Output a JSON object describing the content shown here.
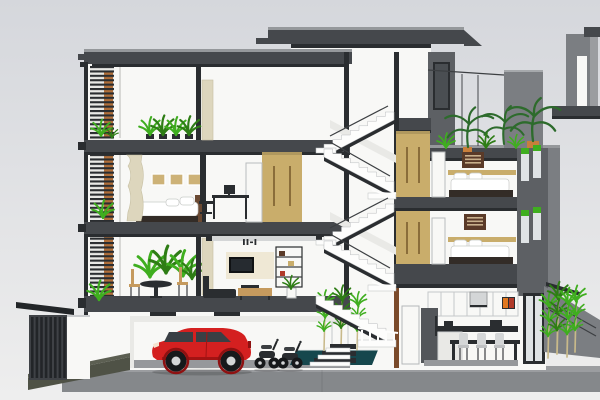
{
  "meta": {
    "description": "3D cutaway section rendering of a four-storey townhouse, SketchUp style",
    "canvas_width": 600,
    "canvas_height": 400
  },
  "palette": {
    "sky_top": "#d5d7dc",
    "sky_bottom": "#eeeeee",
    "ground_top": "#9b9da0",
    "ground_face": "#85888b",
    "slab": "#45484c",
    "slab_dark": "#2a2d30",
    "slab_edge": "#95989b",
    "wall_white": "#f8f8f6",
    "wall_shadow": "#e9e9e6",
    "wall_gray": "#5d6064",
    "wall_gray_light": "#7b7e82",
    "wall_line": "#d8d8d5",
    "wood_tan": "#c9ad6b",
    "wood_tan_dark": "#8a6d3a",
    "wood_orange": "#b06f3a",
    "wood_brown": "#7a4a2a",
    "wood_console": "#c59a5e",
    "panel_beige": "#efe8d5",
    "curtain_beige": "#ddd6bd",
    "green_bright": "#3fae1f",
    "green_dark": "#2e7d15",
    "palm_green": "#2d6b2c",
    "bamboo_stem": "#c8b98a",
    "pot_orange": "#c97f3b",
    "car_red": "#d42020",
    "car_red_dark": "#a31313",
    "glass_light": "#dfe3e5",
    "glass_dark": "#3a3f44",
    "pond_teal": "#16474d",
    "gate_dark": "#222528",
    "gate_frame": "#3f4246",
    "ramp_olive": "#4f5246",
    "ramp_light": "#5c5f52",
    "furniture_dark": "#2a2d30",
    "steel_light": "#d4d6d7",
    "stair_white": "#fdfdfc",
    "art_brown": "#5a3a28",
    "art_line": "#c9b08c",
    "bed_brown": "#6b4a33",
    "bed_base": "#332c27",
    "tire_black": "#17191b",
    "window_tan": "#cdb277",
    "floor_gray": "#96989b",
    "fridge_gray": "#53565a",
    "tv_black": "#101214",
    "accent_orange": "#e07820",
    "accent_red": "#b03a2a",
    "stool_seat": "#bfc1c3"
  },
  "scene": {
    "style": "sketchup-section-perspective",
    "site": {
      "ground": "concrete-pavement",
      "front_gate": "dark-slatted-gate",
      "driveway": "ramp-to-garage",
      "backyard": [
        "sloped-boundary-wall",
        "bamboo-plants",
        "exterior-steps"
      ]
    },
    "building": {
      "stair_tower": {
        "roof": "flat-concrete-roof",
        "stairs": [
          "switchback-flight-level3-4",
          "switchback-flight-level2-3",
          "garage-flight"
        ],
        "window": "tall-dark-window"
      },
      "left_wing": {
        "roof": "flat-concrete-roof-with-brackets",
        "facade": [
          "vertical-post",
          "timber-louver-screen",
          "balcony-planters"
        ],
        "level4_loggia": {
          "objects": [
            "planter-grasses",
            "partition-curtain"
          ]
        },
        "level3": {
          "bedroom": [
            "double-bed",
            "pillows",
            "clerestory-windows",
            "curtain"
          ],
          "study": [
            "desk",
            "monitor",
            "office-chair",
            "tan-wardrobe",
            "door"
          ]
        },
        "level2": {
          "dining": [
            "round-table",
            "dining-chairs",
            "shrub-planter"
          ],
          "living": [
            "ceiling-light-strip",
            "wall-clock",
            "tv",
            "media-shelf",
            "sofa",
            "wood-console",
            "potted-plant",
            "curtain"
          ]
        },
        "ground": {
          "garage": [
            "red-hatchback",
            "two-scooters"
          ]
        }
      },
      "right_wing": {
        "roof_terrace": [
          "potted-palms",
          "grass-tufts",
          "parapet-wall",
          "railing"
        ],
        "upper_bedroom": [
          "wall-art",
          "double-bed",
          "pillows",
          "headboard-shelf",
          "tan-wardrobe",
          "door",
          "facade-windows"
        ],
        "lower_bedroom": [
          "wall-art",
          "double-bed",
          "pillows",
          "headboard-shelf",
          "tan-wardrobe",
          "door",
          "facade-windows"
        ],
        "ground_kitchen": [
          "upper-cabinets",
          "range-hood",
          "small-tv",
          "fridge",
          "counter",
          "dining-table",
          "stools",
          "glass-back-door"
        ]
      },
      "courtyard": [
        "pond",
        "bamboo-plants"
      ]
    },
    "vehicles": {
      "car": "red-hatchback",
      "scooters": 2
    },
    "neighbor": {
      "structure": "gray-stair-bulkhead-with-window"
    }
  }
}
